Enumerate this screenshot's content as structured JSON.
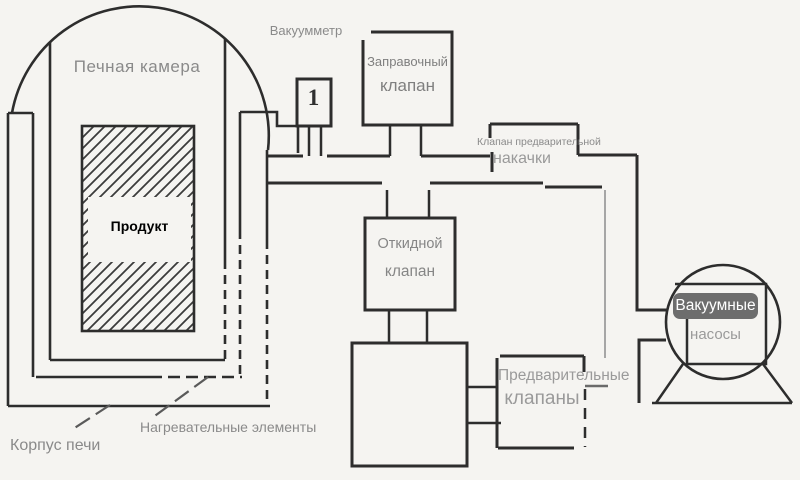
{
  "diagram": {
    "labels": {
      "furnace_chamber": "Печная камера",
      "vacuum_gauge": "Вакуумметр",
      "gauge_reading": "1",
      "fill_valve_line1": "Заправочный",
      "fill_valve_line2": "клапан",
      "prepump_valve_line1": "Клапан предварительной",
      "prepump_valve_line2": "накачки",
      "product": "Продукт",
      "flap_valve_line1": "Откидной",
      "flap_valve_line2": "клапан",
      "preliminary_valves_line1": "Предварительные",
      "preliminary_valves_line2": "клапаны",
      "vacuum_pumps_line1": "Вакуумные",
      "vacuum_pumps_line2": "насосы",
      "furnace_body": "Корпус печи",
      "heating_elements": "Нагревательные элементы"
    },
    "colors": {
      "line": "#2d2d2d",
      "label_text": "#8a8a8a",
      "badge_background": "#6d6d6d",
      "badge_text": "#ffffff",
      "product_text": "#000000",
      "background": "#f5f4f1"
    }
  }
}
